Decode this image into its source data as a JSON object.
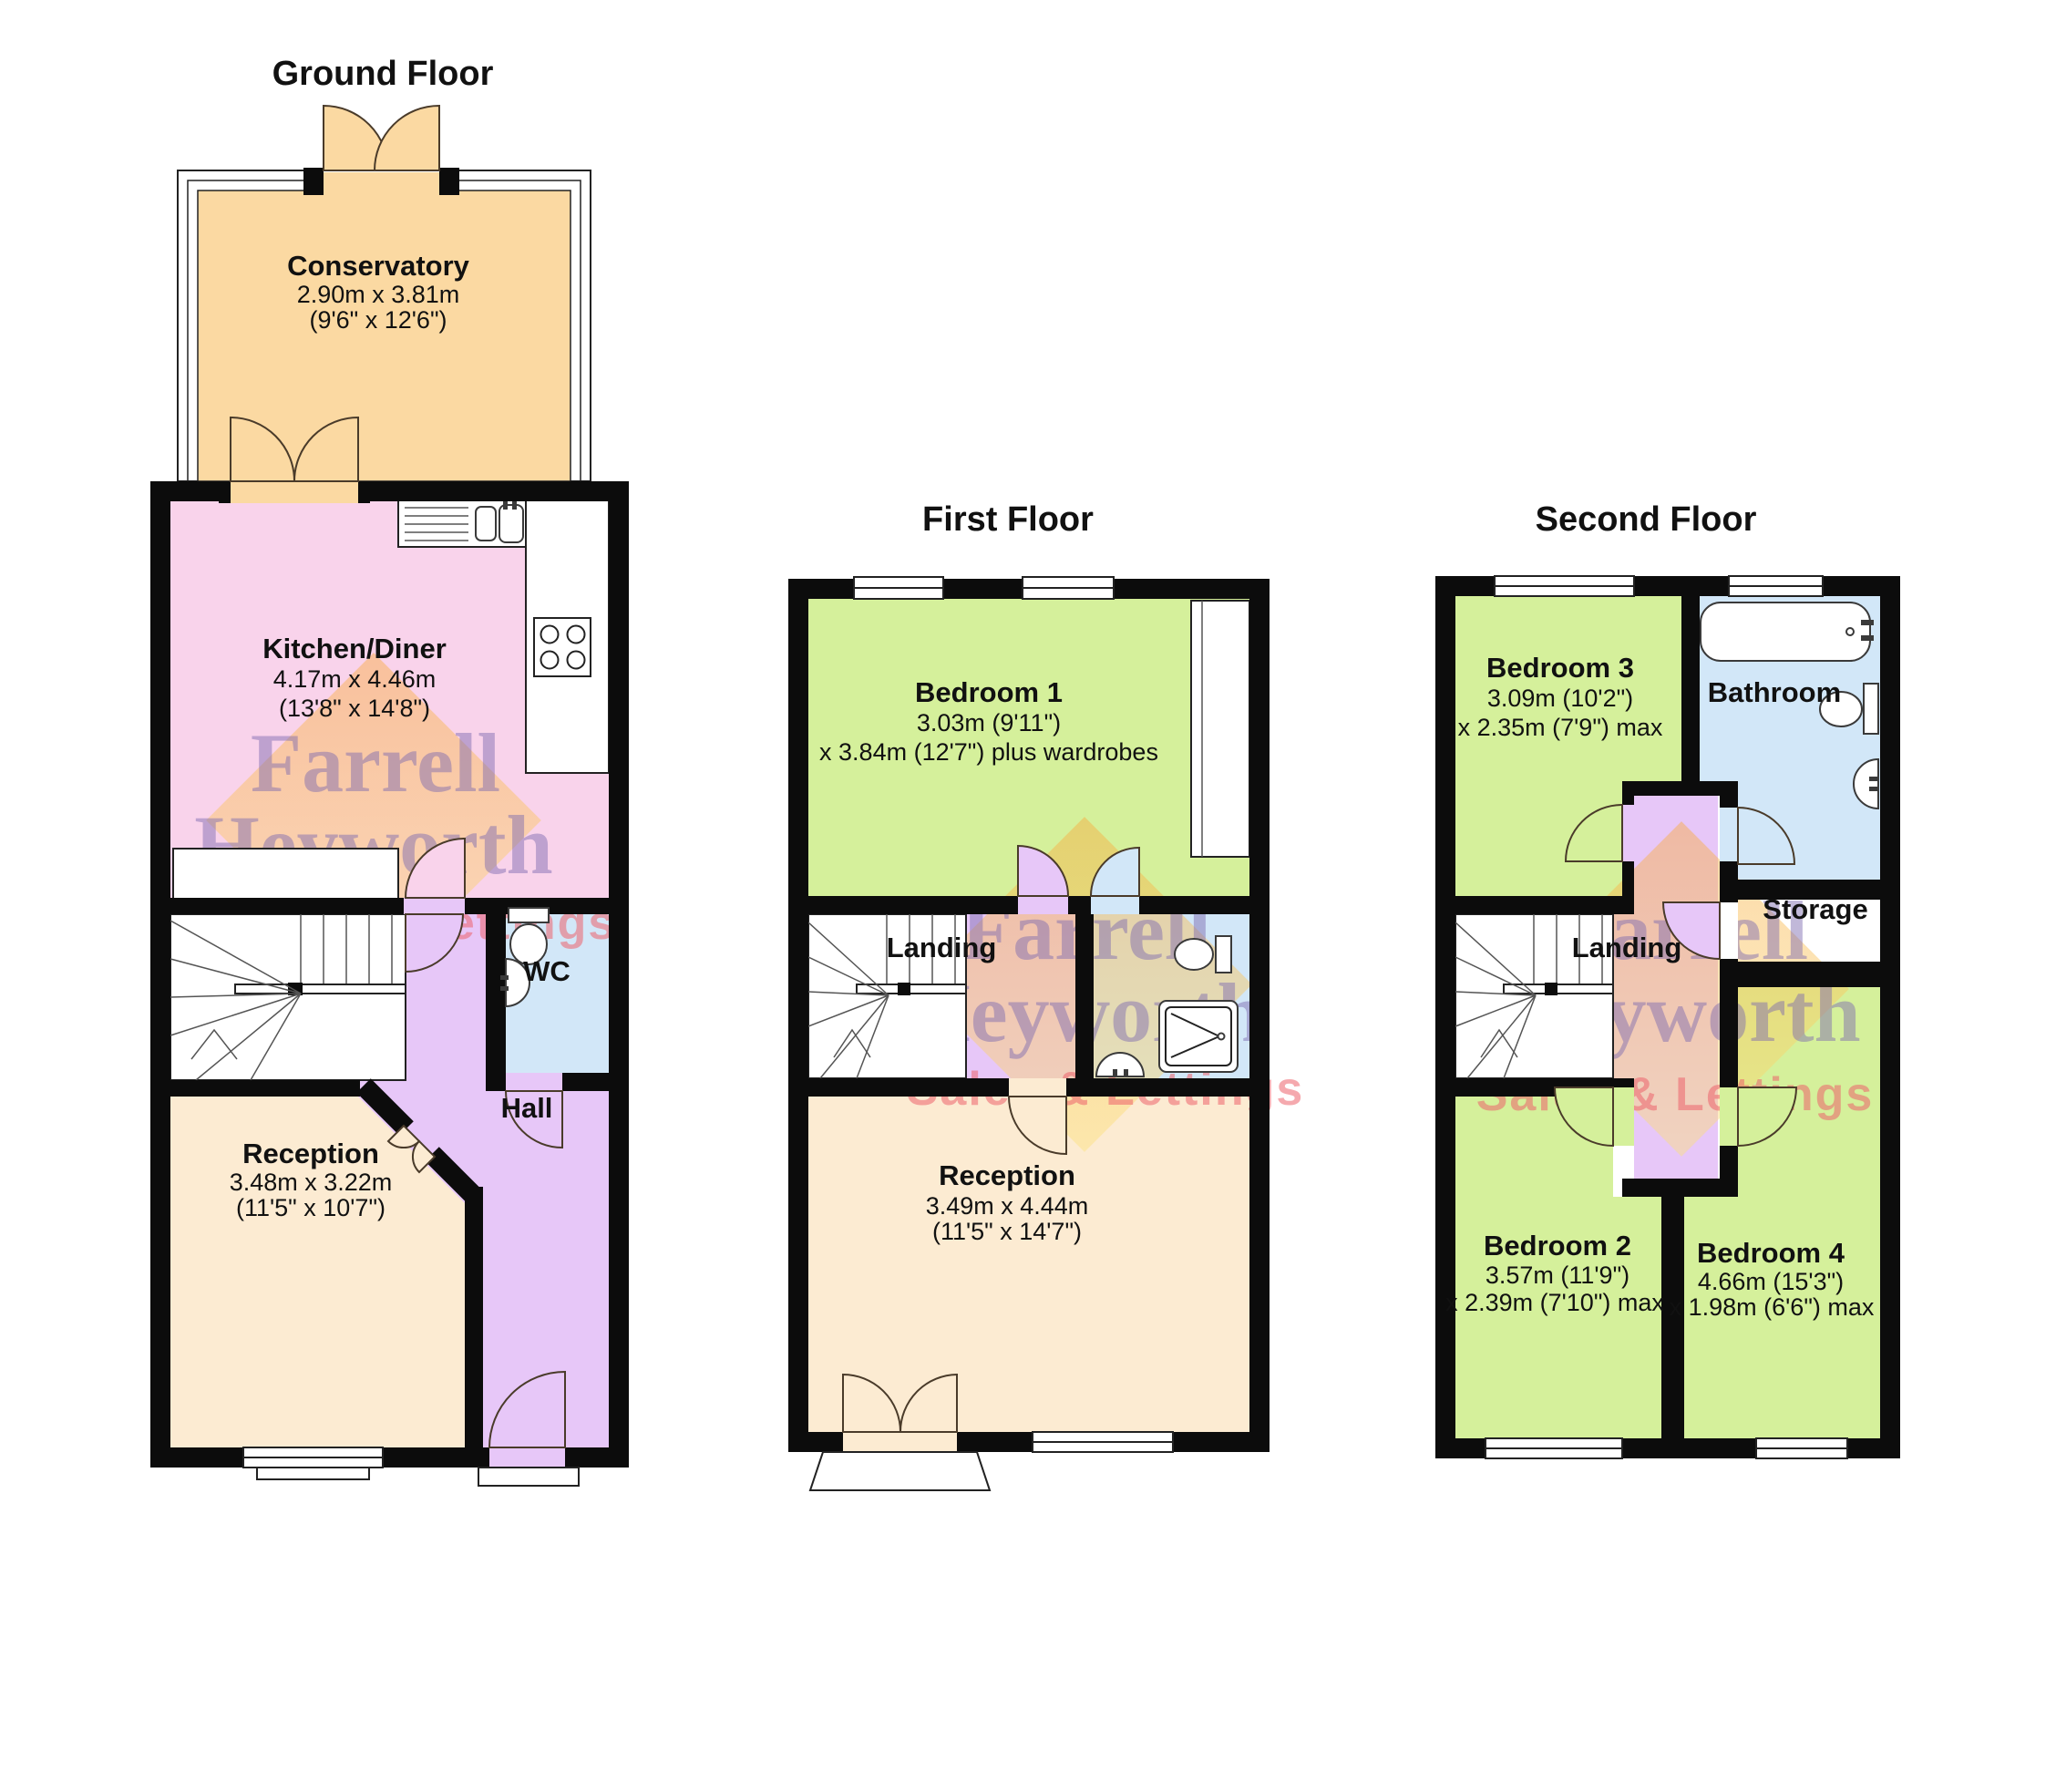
{
  "titles": {
    "ground": "Ground Floor",
    "first": "First Floor",
    "second": "Second Floor"
  },
  "ground": {
    "conservatory": {
      "name": "Conservatory",
      "dim1": "2.90m x 3.81m",
      "dim2": "(9'6\" x 12'6\")"
    },
    "kitchen": {
      "name": "Kitchen/Diner",
      "dim1": "4.17m x 4.46m",
      "dim2": "(13'8\" x 14'8\")"
    },
    "wc": {
      "name": "WC"
    },
    "hall": {
      "name": "Hall"
    },
    "reception": {
      "name": "Reception",
      "dim1": "3.48m x 3.22m",
      "dim2": "(11'5\" x 10'7\")"
    }
  },
  "first": {
    "bedroom1": {
      "name": "Bedroom 1",
      "dim1": "3.03m (9'11\")",
      "dim2": "x 3.84m (12'7\") plus wardrobes"
    },
    "landing": {
      "name": "Landing"
    },
    "reception": {
      "name": "Reception",
      "dim1": "3.49m x 4.44m",
      "dim2": "(11'5\" x 14'7\")"
    }
  },
  "second": {
    "bedroom3": {
      "name": "Bedroom 3",
      "dim1": "3.09m (10'2\")",
      "dim2": "x 2.35m (7'9\") max"
    },
    "bathroom": {
      "name": "Bathroom"
    },
    "storage": {
      "name": "Storage"
    },
    "landing": {
      "name": "Landing"
    },
    "bedroom2": {
      "name": "Bedroom 2",
      "dim1": "3.57m (11'9\")",
      "dim2": "x 2.39m (7'10\") max"
    },
    "bedroom4": {
      "name": "Bedroom 4",
      "dim1": "4.66m (15'3\")",
      "dim2": "x 1.98m (6'6\") max"
    }
  },
  "watermark": {
    "word1": "Farrell",
    "word2": "Heyworth",
    "tagline": "Sales & Lettings"
  },
  "colors": {
    "conservatory": "#FBD9A2",
    "kitchen": "#F9D3EB",
    "hall": "#E7C7F8",
    "bathroom": "#D2E7F8",
    "reception": "#FCEBD2",
    "bedroom": "#D5F09B",
    "wall": "#0c0c0c",
    "watermark_purple": "#7E6AB0",
    "watermark_pink": "#EC626C",
    "watermark_orange": "#F9A93C"
  }
}
